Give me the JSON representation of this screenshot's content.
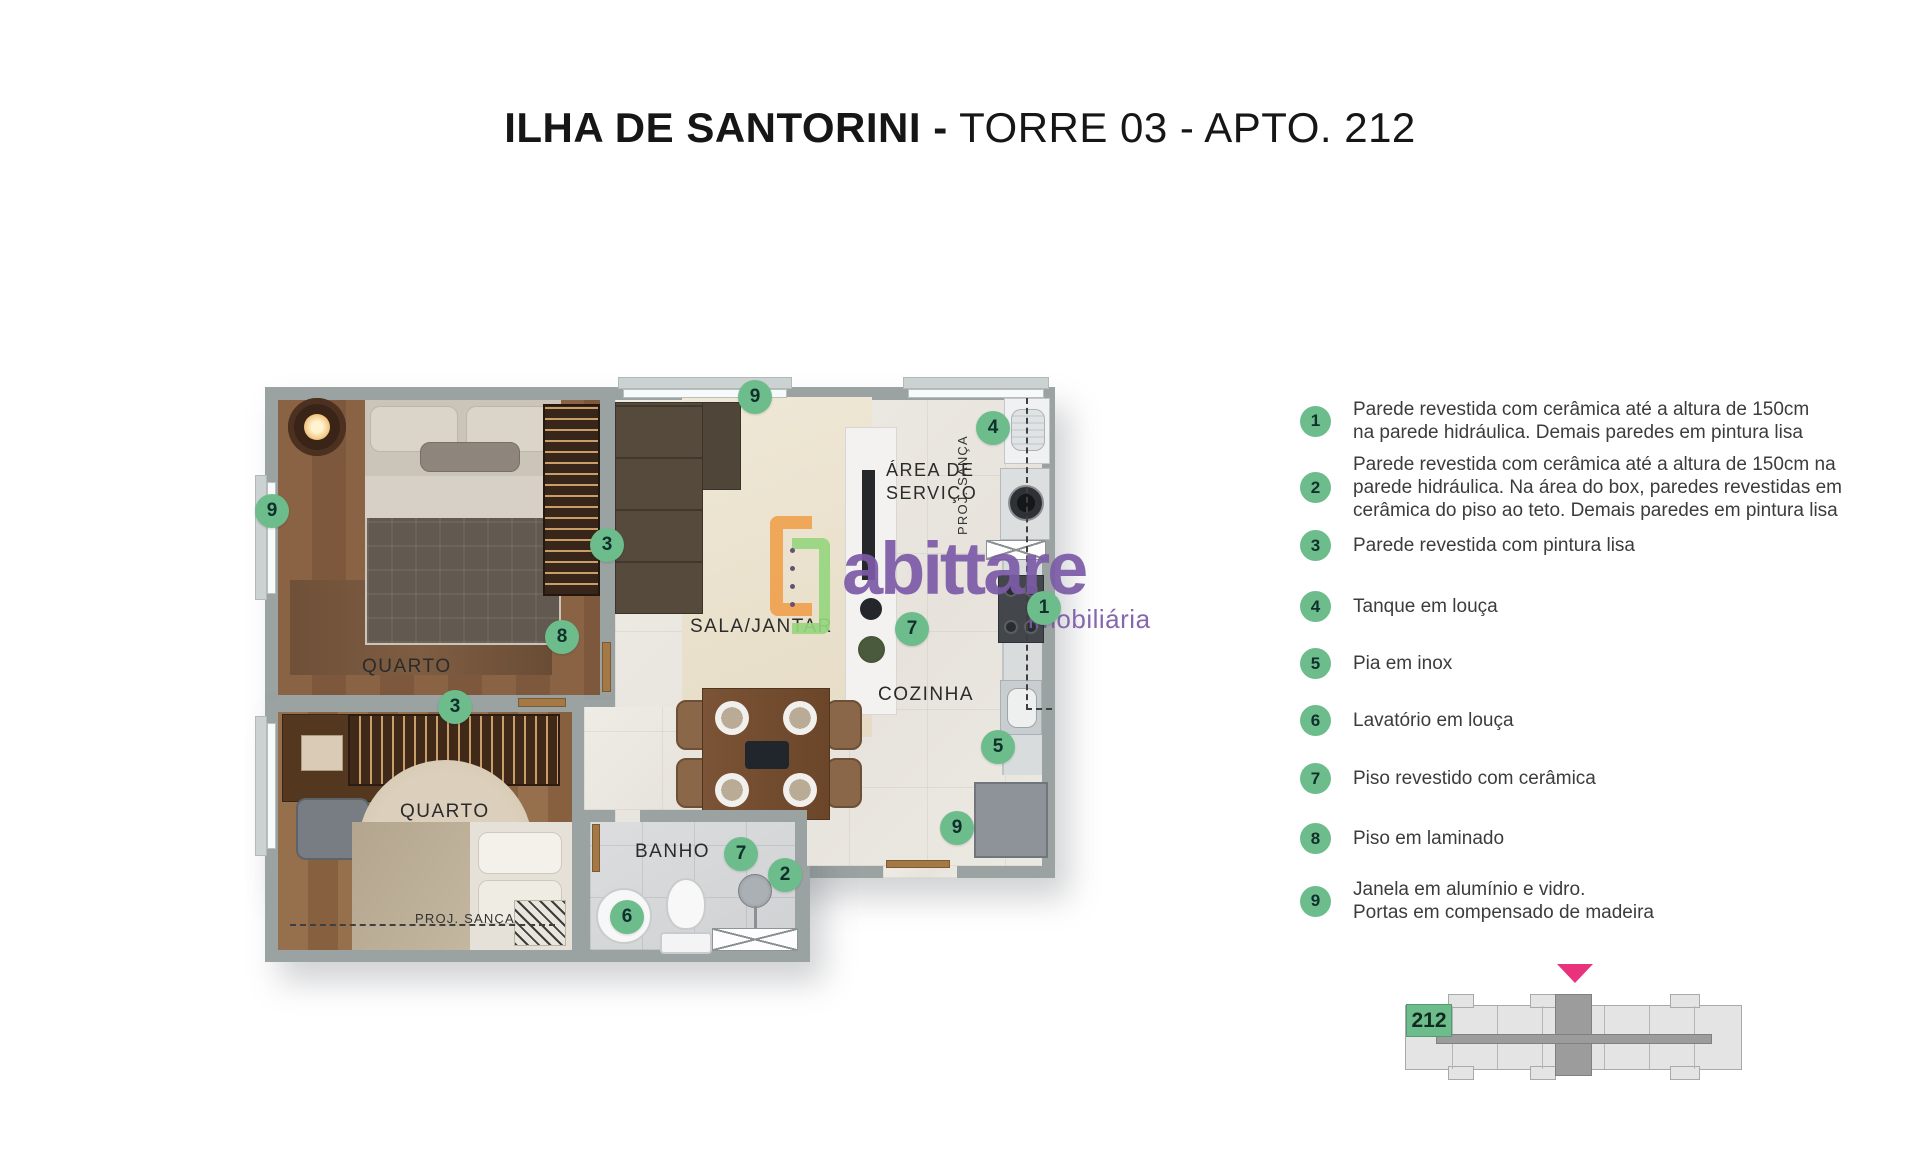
{
  "title": {
    "main": "ILHA DE SANTORINI -",
    "sub": "TORRE 03 - APTO. 212"
  },
  "colors": {
    "badge_green": "#6cbd8b",
    "brand_purple": "#7c5ba7",
    "brand_orange": "#f0a24f",
    "brand_lime": "#97d67f",
    "marker_pink": "#e8327c",
    "wall_gray": "#9aa2a2"
  },
  "floorplan": {
    "labels": {
      "bedroom1": "QUARTO",
      "bedroom2": "QUARTO",
      "living": "SALA/JANTAR",
      "kitchen": "COZINHA",
      "service_line1": "ÁREA DE",
      "service_line2": "SERVIÇO",
      "bath": "BANHO",
      "proj_sanca_bedroom": "PROJ. SANÇA",
      "proj_sanca_service": "PROJ. SANÇA"
    },
    "badges": [
      {
        "n": "9",
        "x": 755,
        "y": 397
      },
      {
        "n": "4",
        "x": 993,
        "y": 428
      },
      {
        "n": "9",
        "x": 272,
        "y": 511
      },
      {
        "n": "3",
        "x": 607,
        "y": 545
      },
      {
        "n": "1",
        "x": 1044,
        "y": 608
      },
      {
        "n": "7",
        "x": 912,
        "y": 629
      },
      {
        "n": "8",
        "x": 562,
        "y": 637
      },
      {
        "n": "3",
        "x": 455,
        "y": 707
      },
      {
        "n": "5",
        "x": 998,
        "y": 747
      },
      {
        "n": "9",
        "x": 957,
        "y": 828
      },
      {
        "n": "7",
        "x": 741,
        "y": 854
      },
      {
        "n": "2",
        "x": 785,
        "y": 875
      },
      {
        "n": "6",
        "x": 627,
        "y": 917
      }
    ]
  },
  "legend": {
    "items": [
      {
        "num": "1",
        "top": 398,
        "lines": [
          "Parede revestida com cerâmica até a altura de 150cm",
          "na parede hidráulica. Demais paredes em pintura lisa"
        ]
      },
      {
        "num": "2",
        "top": 453,
        "lines": [
          "Parede revestida com cerâmica até a altura de 150cm na",
          "parede hidráulica. Na área do box, paredes revestidas em",
          "cerâmica do piso ao teto. Demais paredes em pintura lisa"
        ]
      },
      {
        "num": "3",
        "top": 530,
        "lines": [
          "Parede revestida com pintura lisa"
        ]
      },
      {
        "num": "4",
        "top": 591,
        "lines": [
          "Tanque em louça"
        ]
      },
      {
        "num": "5",
        "top": 648,
        "lines": [
          "Pia em inox"
        ]
      },
      {
        "num": "6",
        "top": 705,
        "lines": [
          "Lavatório em louça"
        ]
      },
      {
        "num": "7",
        "top": 763,
        "lines": [
          "Piso revestido com cerâmica"
        ]
      },
      {
        "num": "8",
        "top": 823,
        "lines": [
          "Piso em laminado"
        ]
      },
      {
        "num": "9",
        "top": 878,
        "lines": [
          "Janela em alumínio e vidro.",
          "Portas em compensado de madeira"
        ]
      }
    ]
  },
  "logo": {
    "brand": "abittare",
    "tagline": "imobiliária"
  },
  "keyplan": {
    "unit": "212"
  }
}
